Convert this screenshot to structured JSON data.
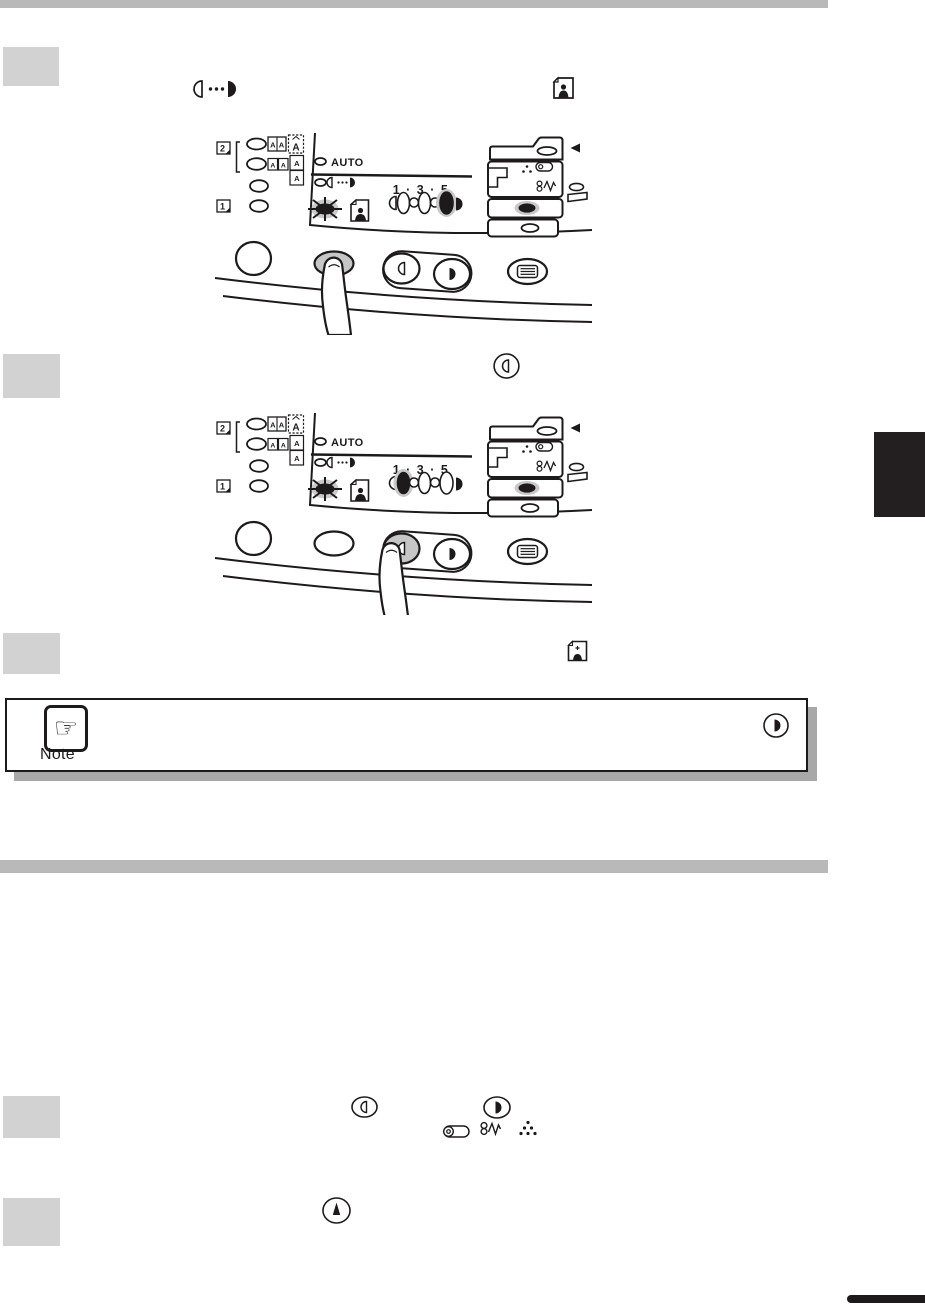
{
  "colors": {
    "bar_gray": "#b9b9b9",
    "step_box_gray": "#d2d2d2",
    "line_black": "#1d1a1b",
    "chapter_tab_black": "#231f20",
    "pressed_button_gray": "#c6c6c6",
    "led_halo_gray": "#c9c9c9",
    "note_shadow_gray": "#a8a8a8"
  },
  "panels": [
    {
      "auto_label": "AUTO",
      "scale_label": "1 · 3 · 5",
      "duplex_badge": "2",
      "single_badge": "1",
      "original_glyph": "A",
      "lit_exposure_level": 5,
      "pressed_button": "exposure-mode-button"
    },
    {
      "auto_label": "AUTO",
      "scale_label": "1 · 3 · 5",
      "duplex_badge": "2",
      "single_badge": "1",
      "original_glyph": "A",
      "lit_exposure_level": 1,
      "pressed_button": "lighten-button"
    }
  ],
  "steps": [
    {
      "step": 1,
      "icons": [
        "exposure-manual-icon",
        "photo-mode-icon"
      ]
    },
    {
      "step": 2,
      "icons": [
        "lighten-button-icon"
      ]
    },
    {
      "step": 3,
      "icons": [
        "photo-mode-icon"
      ]
    },
    {
      "step": 4,
      "icons": [
        "lighten-button-icon",
        "darken-button-icon",
        "drum-cartridge-icon",
        "misfeed-icon",
        "toner-dots-icon"
      ]
    },
    {
      "step": 5,
      "icons": [
        "up-button-icon"
      ]
    }
  ],
  "note": {
    "label": "Note",
    "hand_glyph": "☞",
    "icons": [
      "darken-button-icon"
    ]
  }
}
